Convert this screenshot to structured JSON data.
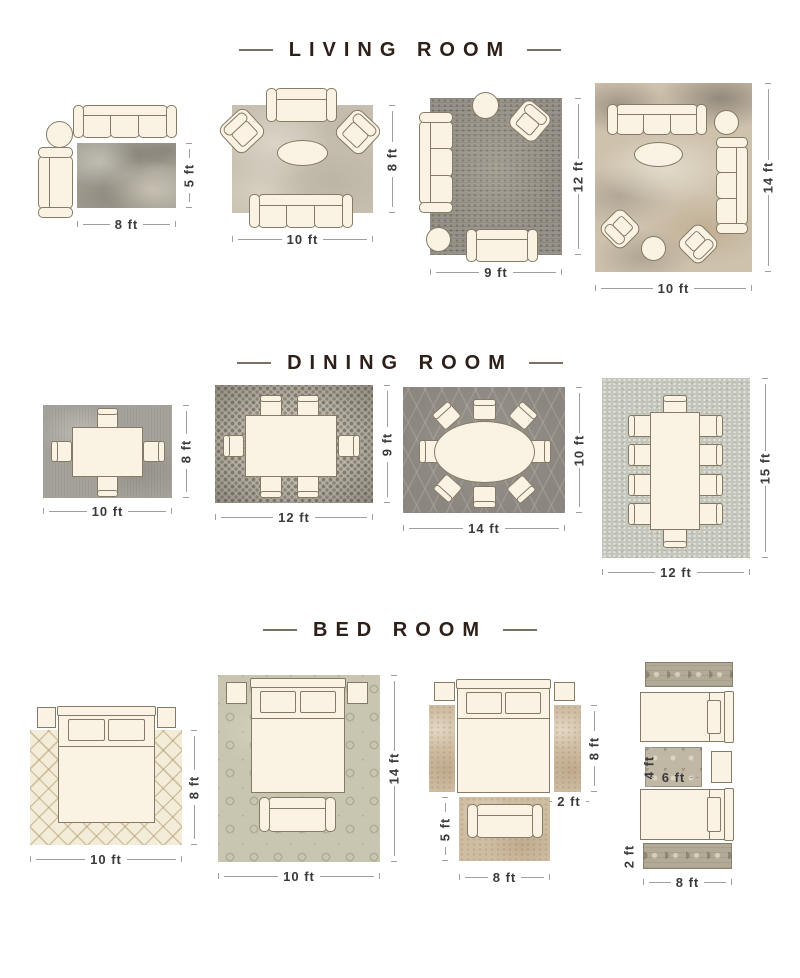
{
  "colors": {
    "title_text": "#2e2018",
    "dimension_text": "#3a3a3a",
    "dimension_line": "#9f9f9f",
    "furniture_fill": "#faf3e3",
    "furniture_outline": "#857a66"
  },
  "sections": [
    {
      "title": "LIVING ROOM",
      "layouts": [
        {
          "rug_width": "8 ft",
          "rug_height": "5 ft"
        },
        {
          "rug_width": "10 ft",
          "rug_height": "8 ft"
        },
        {
          "rug_width": "9 ft",
          "rug_height": "12 ft"
        },
        {
          "rug_width": "10 ft",
          "rug_height": "14 ft"
        }
      ]
    },
    {
      "title": "DINING ROOM",
      "layouts": [
        {
          "rug_width": "10 ft",
          "rug_height": "8 ft"
        },
        {
          "rug_width": "12 ft",
          "rug_height": "9 ft"
        },
        {
          "rug_width": "14 ft",
          "rug_height": "10 ft"
        },
        {
          "rug_width": "12 ft",
          "rug_height": "15 ft"
        }
      ]
    },
    {
      "title": "BED ROOM",
      "layouts": [
        {
          "rug_width": "10 ft",
          "rug_height": "8 ft"
        },
        {
          "rug_width": "10 ft",
          "rug_height": "14 ft"
        },
        {
          "runner_height": "8 ft",
          "runner_width": "2 ft",
          "foot_rug_height": "5 ft",
          "foot_rug_width": "8 ft"
        },
        {
          "small_rug_height": "4 ft",
          "small_rug_width": "6 ft",
          "runner_height": "2 ft",
          "runner_width": "8 ft"
        }
      ]
    }
  ]
}
